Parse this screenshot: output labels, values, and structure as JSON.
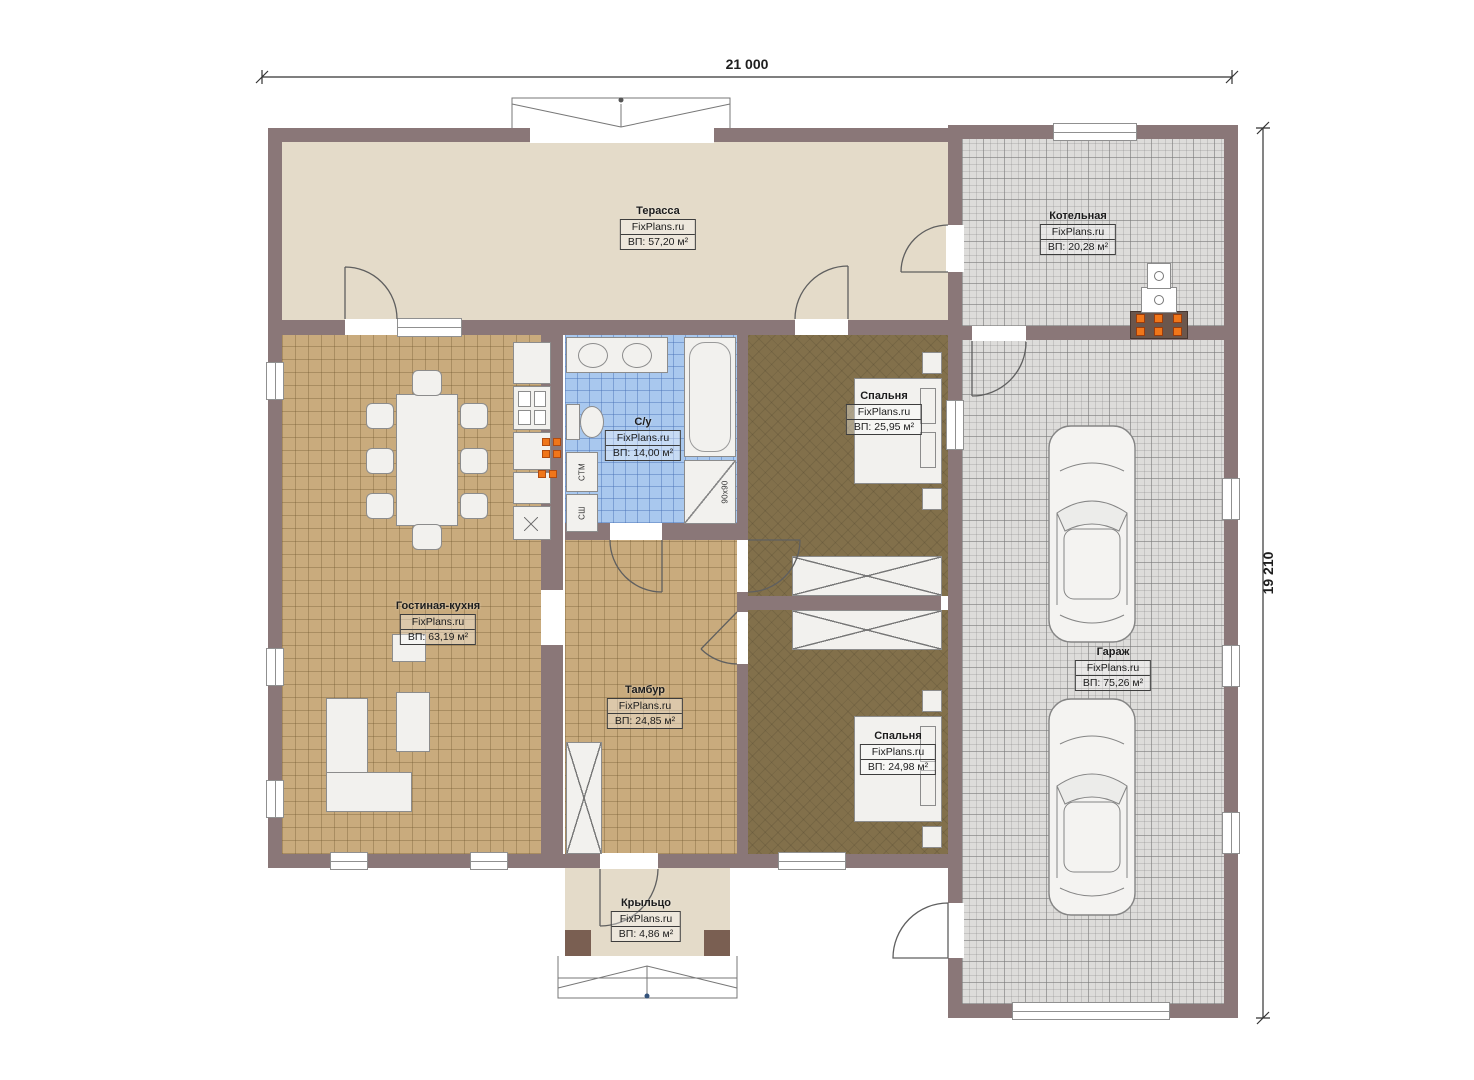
{
  "plan": {
    "brand": "FixPlans.ru",
    "dimensions": {
      "width_label": "21 000",
      "height_label": "19 210"
    },
    "rooms": [
      {
        "key": "terrace",
        "name": "Терасса",
        "brand": "FixPlans.ru",
        "area": "ВП: 57,20 м²"
      },
      {
        "key": "boiler-room",
        "name": "Котельная",
        "brand": "FixPlans.ru",
        "area": "ВП: 20,28 м²"
      },
      {
        "key": "bathroom",
        "name": "С/у",
        "brand": "FixPlans.ru",
        "area": "ВП: 14,00 м²"
      },
      {
        "key": "bedroom-top",
        "name": "Спальня",
        "brand": "FixPlans.ru",
        "area": "ВП: 25,95 м²"
      },
      {
        "key": "living-kitchen",
        "name": "Гостиная-кухня",
        "brand": "FixPlans.ru",
        "area": "ВП: 63,19 м²"
      },
      {
        "key": "vestibule",
        "name": "Тамбур",
        "brand": "FixPlans.ru",
        "area": "ВП: 24,85 м²"
      },
      {
        "key": "bedroom-bottom",
        "name": "Спальня",
        "brand": "FixPlans.ru",
        "area": "ВП: 24,98 м²"
      },
      {
        "key": "garage",
        "name": "Гараж",
        "brand": "FixPlans.ru",
        "area": "ВП: 75,26 м²"
      },
      {
        "key": "porch",
        "name": "Крыльцо",
        "brand": "FixPlans.ru",
        "area": "ВП: 4,86 м²"
      }
    ],
    "appliances": {
      "washing_machine_label": "СТМ",
      "dryer_label": "СШ",
      "shower_size_label": "90x90"
    },
    "colors": {
      "wall": "#8a7778",
      "terrace_floor": "#e4dbc9",
      "tile_tan": "#c9ab7d",
      "tile_blue": "#a9c8ee",
      "bedroom_floor": "#82704b",
      "garage_floor": "#dddcda",
      "accent_orange": "#f0761a"
    }
  }
}
